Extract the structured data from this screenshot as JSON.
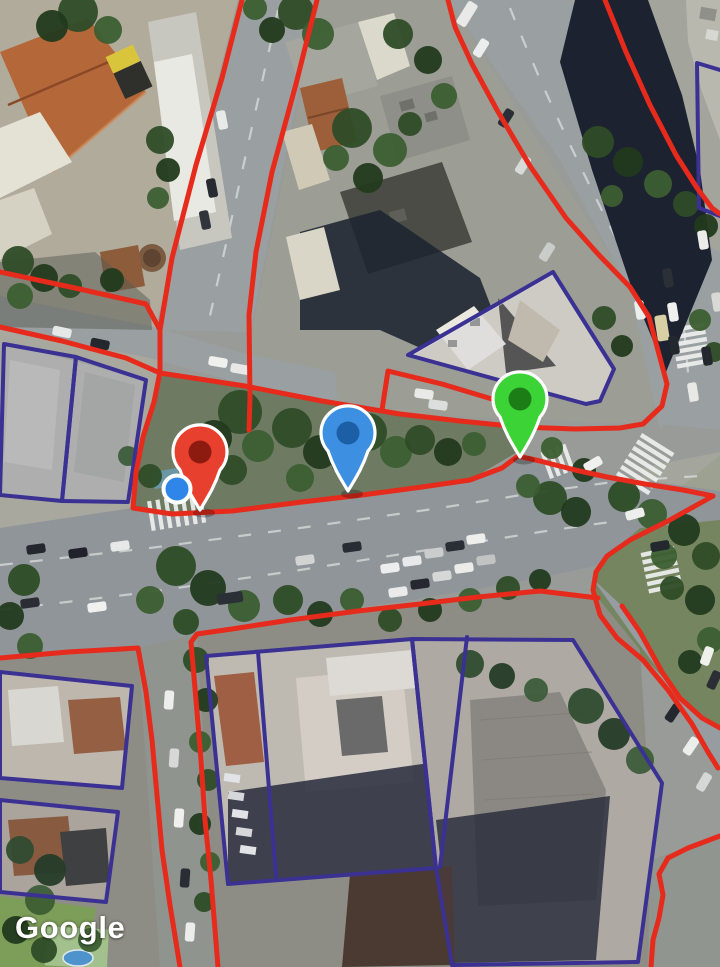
{
  "map": {
    "provider_logo": "Google",
    "overlay_colors": {
      "boundary_red": "#e62a1c",
      "parcel_blue": "#3a3193"
    },
    "red_boundaries": [
      [
        [
          242,
          0
        ],
        [
          222,
          78
        ],
        [
          196,
          165
        ],
        [
          172,
          258
        ],
        [
          160,
          330
        ],
        [
          160,
          372
        ]
      ],
      [
        [
          317,
          0
        ],
        [
          296,
          84
        ],
        [
          272,
          172
        ],
        [
          256,
          252
        ],
        [
          249,
          315
        ],
        [
          250,
          398
        ],
        [
          249,
          430
        ]
      ],
      [
        [
          160,
          372
        ],
        [
          154,
          402
        ],
        [
          143,
          437
        ],
        [
          136,
          472
        ],
        [
          133,
          508
        ],
        [
          172,
          514
        ],
        [
          232,
          511
        ],
        [
          302,
          502
        ],
        [
          362,
          495
        ],
        [
          422,
          487
        ],
        [
          470,
          480
        ],
        [
          502,
          468
        ],
        [
          518,
          456
        ],
        [
          540,
          461
        ],
        [
          575,
          470
        ],
        [
          607,
          477
        ],
        [
          645,
          484
        ],
        [
          683,
          490
        ],
        [
          713,
          496
        ]
      ],
      [
        [
          0,
          327
        ],
        [
          62,
          341
        ],
        [
          126,
          358
        ],
        [
          160,
          373
        ],
        [
          245,
          386
        ],
        [
          322,
          401
        ],
        [
          400,
          414
        ],
        [
          460,
          421
        ],
        [
          520,
          427
        ],
        [
          575,
          429
        ],
        [
          620,
          428
        ],
        [
          643,
          424
        ],
        [
          662,
          406
        ],
        [
          667,
          384
        ],
        [
          649,
          317
        ],
        [
          630,
          287
        ],
        [
          598,
          254
        ],
        [
          566,
          218
        ],
        [
          530,
          166
        ],
        [
          497,
          110
        ],
        [
          472,
          64
        ],
        [
          455,
          27
        ],
        [
          448,
          0
        ]
      ],
      [
        [
          382,
          410
        ],
        [
          388,
          371
        ],
        [
          442,
          384
        ],
        [
          492,
          399
        ],
        [
          516,
          413
        ],
        [
          523,
          438
        ]
      ],
      [
        [
          605,
          0
        ],
        [
          626,
          52
        ],
        [
          650,
          105
        ],
        [
          676,
          155
        ],
        [
          697,
          188
        ],
        [
          712,
          208
        ],
        [
          720,
          214
        ]
      ],
      [
        [
          713,
          496
        ],
        [
          668,
          521
        ],
        [
          630,
          540
        ],
        [
          607,
          556
        ],
        [
          596,
          572
        ],
        [
          593,
          590
        ],
        [
          600,
          615
        ],
        [
          617,
          638
        ],
        [
          643,
          660
        ],
        [
          668,
          690
        ],
        [
          692,
          724
        ],
        [
          708,
          752
        ],
        [
          718,
          768
        ]
      ],
      [
        [
          622,
          606
        ],
        [
          640,
          632
        ],
        [
          662,
          672
        ],
        [
          680,
          698
        ],
        [
          702,
          718
        ],
        [
          720,
          728
        ]
      ],
      [
        [
          720,
          836
        ],
        [
          688,
          848
        ],
        [
          668,
          858
        ],
        [
          659,
          874
        ],
        [
          663,
          895
        ],
        [
          659,
          918
        ],
        [
          653,
          940
        ],
        [
          651,
          967
        ]
      ],
      [
        [
          598,
          598
        ],
        [
          540,
          591
        ],
        [
          478,
          597
        ],
        [
          420,
          604
        ],
        [
          358,
          611
        ],
        [
          290,
          620
        ],
        [
          232,
          629
        ],
        [
          197,
          634
        ],
        [
          191,
          642
        ],
        [
          196,
          700
        ],
        [
          201,
          760
        ],
        [
          205,
          820
        ],
        [
          211,
          880
        ],
        [
          218,
          967
        ]
      ],
      [
        [
          0,
          658
        ],
        [
          68,
          652
        ],
        [
          138,
          648
        ],
        [
          146,
          692
        ],
        [
          152,
          740
        ],
        [
          157,
          795
        ],
        [
          162,
          850
        ],
        [
          170,
          905
        ],
        [
          180,
          967
        ]
      ],
      [
        [
          0,
          272
        ],
        [
          75,
          288
        ],
        [
          146,
          304
        ],
        [
          160,
          330
        ]
      ]
    ],
    "blue_parcels": [
      {
        "closed": true,
        "points": [
          [
            408,
            355
          ],
          [
            553,
            272
          ],
          [
            614,
            369
          ],
          [
            600,
            401
          ],
          [
            586,
            404
          ]
        ]
      },
      {
        "closed": true,
        "points": [
          [
            4,
            344
          ],
          [
            76,
            357
          ],
          [
            62,
            501
          ],
          [
            0,
            495
          ]
        ]
      },
      {
        "closed": true,
        "points": [
          [
            76,
            357
          ],
          [
            146,
            380
          ],
          [
            128,
            502
          ],
          [
            62,
            501
          ]
        ]
      },
      {
        "closed": true,
        "points": [
          [
            206,
            656
          ],
          [
            412,
            639
          ],
          [
            436,
            868
          ],
          [
            228,
            884
          ]
        ]
      },
      {
        "closed": false,
        "points": [
          [
            258,
            652
          ],
          [
            276,
            876
          ]
        ]
      },
      {
        "closed": true,
        "points": [
          [
            412,
            639
          ],
          [
            573,
            640
          ],
          [
            662,
            783
          ],
          [
            638,
            962
          ],
          [
            452,
            965
          ],
          [
            436,
            868
          ]
        ]
      },
      {
        "closed": false,
        "points": [
          [
            467,
            637
          ],
          [
            440,
            867
          ]
        ]
      },
      {
        "closed": true,
        "points": [
          [
            0,
            672
          ],
          [
            132,
            686
          ],
          [
            122,
            788
          ],
          [
            0,
            778
          ]
        ]
      },
      {
        "closed": true,
        "points": [
          [
            0,
            800
          ],
          [
            118,
            812
          ],
          [
            106,
            902
          ],
          [
            0,
            892
          ]
        ]
      },
      {
        "closed": false,
        "points": [
          [
            720,
            70
          ],
          [
            697,
            63
          ],
          [
            699,
            208
          ],
          [
            720,
            216
          ]
        ]
      }
    ],
    "markers": [
      {
        "id": "map-marker-red",
        "tip_x": 200,
        "tip_y": 510,
        "body": "#e8402f",
        "inner": "#8e1b0f"
      },
      {
        "id": "map-marker-blue",
        "tip_x": 348,
        "tip_y": 491,
        "body": "#3d8fe2",
        "inner": "#1c5fa6"
      },
      {
        "id": "map-marker-green",
        "tip_x": 520,
        "tip_y": 457,
        "body": "#3bd335",
        "inner": "#1c7d16"
      }
    ],
    "location_dot": {
      "x": 177,
      "y": 489,
      "r": 13.5,
      "fill": "#2f86e8",
      "stroke": "#ffffff"
    }
  }
}
